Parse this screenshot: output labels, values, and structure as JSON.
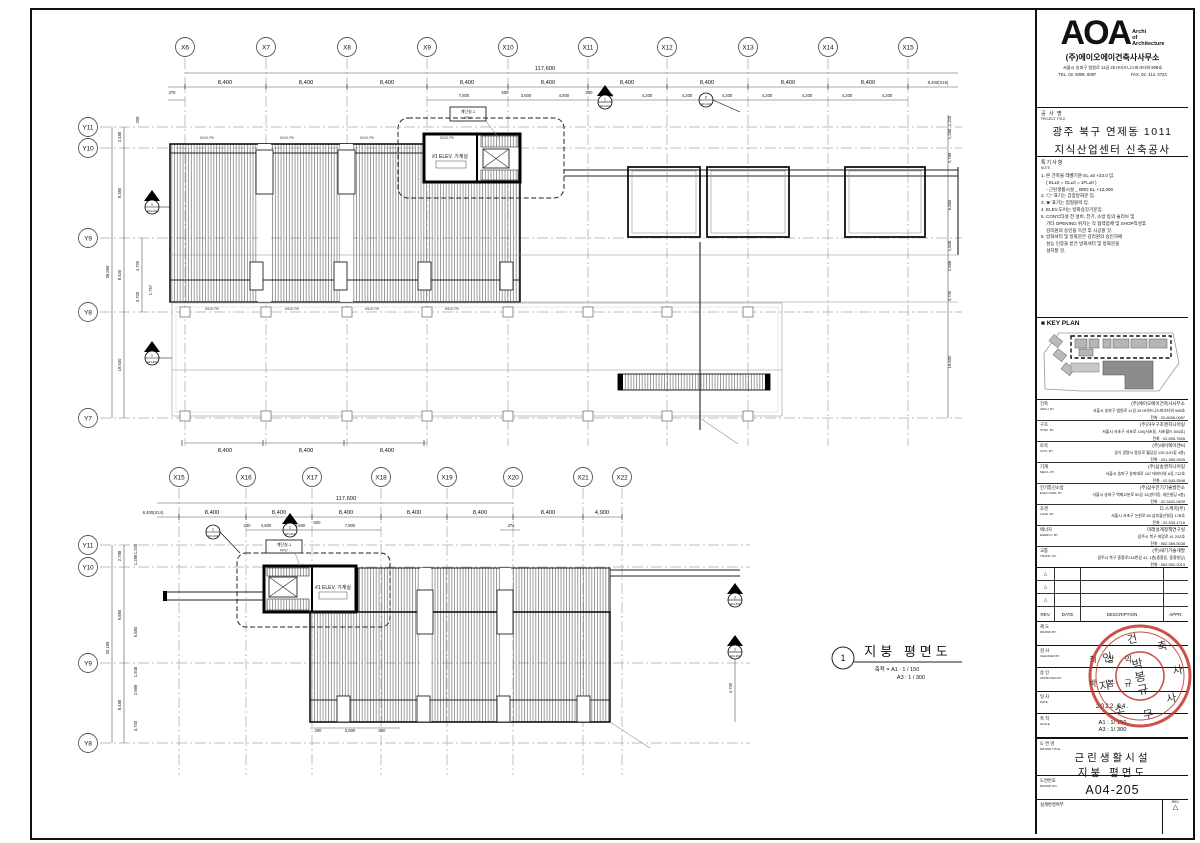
{
  "plan_top": {
    "x_grids": [
      "X6",
      "X7",
      "X8",
      "X9",
      "X10",
      "X11",
      "X12",
      "X13",
      "X14",
      "X15"
    ],
    "x_edge": "8,400(X16)",
    "total": "117,600",
    "seg": "8,400",
    "half": "4,200",
    "subs": {
      "s375": "375",
      "s7800": "7,800",
      "s600": "600",
      "s3600": "3,600",
      "s4800": "4,800",
      "s200": "200"
    },
    "y_grids": [
      "Y11",
      "Y10",
      "Y9",
      "Y8",
      "Y7"
    ],
    "y_total": "39,868",
    "y_segs": [
      "2,488",
      "9,380",
      "8,400",
      "19,600"
    ],
    "y_subs": [
      "208",
      "4,700",
      "3,700",
      "1,767"
    ],
    "right_dims": [
      "1,200",
      "1,288",
      "2,788",
      "6,880",
      "1,848",
      "2,988",
      "3,700",
      "19,600"
    ],
    "core_tag1": "계단실-1",
    "core_tag2": "RTU",
    "core_label": "#1 ELEV. 기계실",
    "drain": "Ø100 PB"
  },
  "plan_bottom": {
    "x_grids": [
      "X15",
      "X16",
      "X17",
      "X18",
      "X19",
      "X20",
      "X21",
      "X22"
    ],
    "x_edge": "8,400(X14)",
    "total": "117,600",
    "seg": "8,400",
    "last": "4,900",
    "subs": {
      "s200": "200",
      "s4600": "4,600",
      "s3600": "3,600",
      "s600": "600",
      "s7800": "7,800",
      "s375": "375"
    },
    "y_grids": [
      "Y11",
      "Y10",
      "Y9",
      "Y8"
    ],
    "y_total": "20,188",
    "y_segs": [
      "2,788",
      "9,880",
      "8,488"
    ],
    "y_subs": [
      "1,200",
      "1,288",
      "6,880",
      "1,848",
      "2,988",
      "3,700"
    ],
    "right_dim": "4,700",
    "bottom_subs": [
      "200",
      "3,600",
      "600"
    ],
    "core_tag1": "계단실-1",
    "core_tag2": "RTU",
    "core_label": "#1 ELEV. 기계실"
  },
  "markers": {
    "n1": "1",
    "n2": "2",
    "s202": "A04-202",
    "s203": "A04-203"
  },
  "caption": {
    "num": "1",
    "title": "지붕 평면도",
    "scale1": "축척 = A1 : 1 / 150",
    "scale2": "A3 : 1 / 300"
  },
  "titleblock": {
    "logo_main": "AOA",
    "logo_sub1": "Archi",
    "logo_sub2": "of",
    "logo_sub3": "Architecture",
    "firm": "(주)에이오에이건축사사무소",
    "firm_addr": "서울시 송파구 법원로 11길 25 H비즈니스파크타워 908호",
    "firm_tel": "TEL. 02. 6006. 0087",
    "firm_fax": "FAX. 02. 412. 0723",
    "project": {
      "kr": "공 사 명",
      "en": "PROJECT TITLE.",
      "line1": "광주 북구 연제동 1011",
      "line2": "지식산업센터 신축공사"
    },
    "note": {
      "kr": "특기사항",
      "en": "NOTE.",
      "lines": [
        "1. 본 건축물 레벨기준 EL ±0 +23.0 임.",
        "    ( EL±0 = GL±0 = 1FL±0 )",
        "    - 근린생활시설 _ BRD EL +12,000",
        "2. '◎' 표기는 갑종방화문 임.",
        "3. '■' 표기는 점형블럭 임.",
        "4. ELEV.도어는 방화승강기문임.",
        "5. CON'C타설 전 설비, 전기, 소방 등의 슬리브 및",
        "    기타 OPENING 위치는 각 협력업체 및 SHOP작성후",
        "    감리원의 승인을 득한 후 시공할 것.",
        "6. 방화셔터 및 방화문은 감리원의 승인하에",
        "    성능 인증을 받은 방화셔터 및 방화문을",
        "    설치할 것."
      ]
    },
    "keyplan_label": "■ KEY PLAN",
    "consultants": [
      {
        "kr": "건축",
        "en": "ARCH. BY",
        "name": "(주)에이오에이건축사사무소",
        "addr": "서울시 송파구 법원로 11길 25 H비즈니스파크타워 908호",
        "tel": "전화 : 02-6006-0087"
      },
      {
        "kr": "구조",
        "en": "STRU. BY",
        "name": "(주)하우구조엔지니어링",
        "addr": "서울시 서초구 서초로 100(서초동, 서초월드 504호)",
        "tel": "전화 : 02-595-7635"
      },
      {
        "kr": "토목",
        "en": "CIVIL. BY",
        "name": "(주)세이택이앤씨",
        "addr": "경기 광명시 중앙로 월담길 126 (101동 4층)",
        "tel": "전화 : 031-369-2639"
      },
      {
        "kr": "기계",
        "en": "MECA. BY",
        "name": "(주)삼송엔지니어링",
        "addr": "서울시 송파구 송파대로 167 테라타워 A동 712호",
        "tel": "전화 : 02-543-3548"
      },
      {
        "kr": "전기통신소방",
        "en": "ELEC/ FIRE. BY",
        "name": "(주)삼수전기기술발전소",
        "addr": "서울시 송파구 백제고분로 50길 12(방이동, 세은빌딩 4층)",
        "tel": "전화 : 02-3431-0639"
      },
      {
        "kr": "조경",
        "en": "LAND. BY",
        "name": "디.스케치(주)",
        "addr": "서울시 서초구 논현로 83 삼호물산빌딩 17B호",
        "tel": "전화 : 02-533-1716"
      },
      {
        "kr": "에너지",
        "en": "ENERGY. BY",
        "name": "미래설계정책연구실",
        "addr": "광주시 북구 희망로 41 202호",
        "tel": "전화 : 062-369-5038"
      },
      {
        "kr": "교통",
        "en": "TRAFIC. BY",
        "name": "(주)세기기술개발",
        "addr": "광주시 북구 중흥로218번길 41, 1층(중흥동, 중흥빌딩)",
        "tel": "전화 : 062-952-2013"
      }
    ],
    "rev": {
      "rev": "REV.",
      "date": "DATE",
      "desc": "DESCRIPTION",
      "appr": "APPR.",
      "tri": "△"
    },
    "rows": {
      "drawn": {
        "kr": "제 도",
        "en": "DRAWN BY.",
        "value": ""
      },
      "checked": {
        "kr": "검 사",
        "en": "CHECKED BY.",
        "value": "최 상 익"
      },
      "approved": {
        "kr": "승 인",
        "en": "APPROVED BY.",
        "value": "박 봉 규"
      },
      "date": {
        "kr": "일 자",
        "en": "DATE.",
        "value": "2022.04."
      },
      "scale": {
        "kr": "축 척",
        "en": "SCALE.",
        "v1": "A1 : 1/ 150",
        "v2": "A3 : 1/ 300"
      },
      "title": {
        "kr": "도 면 명",
        "en": "DRAWN TITLE.",
        "line1": "근린생활시설",
        "line2": "지붕 평면도"
      },
      "no": {
        "kr": "도면번호",
        "en": "DRAWN NO.",
        "value": "A04-205"
      },
      "revcheck": {
        "kr": "설계변경여부",
        "rev": "REV.",
        "tri": "△"
      }
    },
    "stamp": {
      "c1": "박",
      "c2": "봉",
      "c3": "규",
      "ring": "건축사사무소"
    }
  }
}
